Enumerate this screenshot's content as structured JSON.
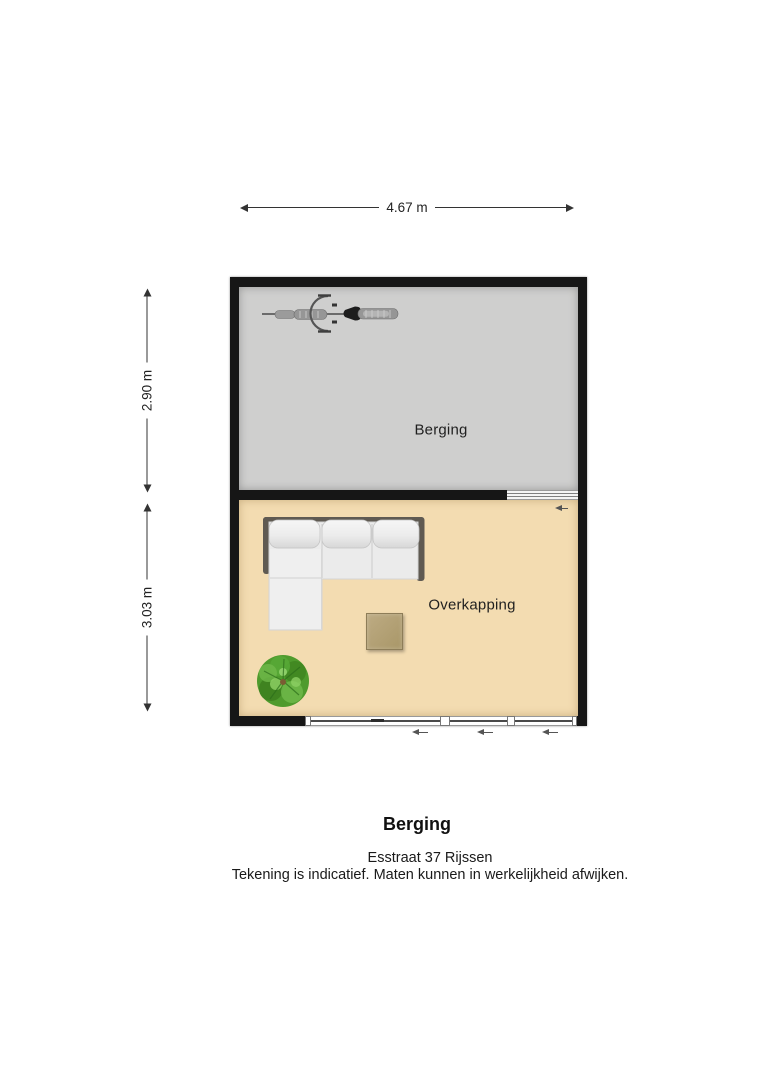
{
  "plan": {
    "wall_color": "#161616",
    "dimensions": [
      {
        "id": "total-width",
        "label": "4.67 m",
        "orientation": "horizontal"
      },
      {
        "id": "berging-depth",
        "label": "2.90 m",
        "orientation": "vertical"
      },
      {
        "id": "overkapping-depth",
        "label": "3.03 m",
        "orientation": "vertical"
      }
    ],
    "rooms": [
      {
        "id": "berging",
        "label": "Berging",
        "floor_color": "#cfcfce"
      },
      {
        "id": "overkapping",
        "label": "Overkapping",
        "floor_color": "#f3dcb1"
      }
    ],
    "furniture": [
      {
        "icon": "bicycle-icon",
        "room": "berging"
      },
      {
        "icon": "corner-sofa-icon",
        "room": "overkapping",
        "color": "#ebebeb"
      },
      {
        "icon": "side-table-icon",
        "room": "overkapping",
        "color": "#b3a179"
      },
      {
        "icon": "plant-icon",
        "room": "overkapping",
        "color": "#4f9b2d"
      }
    ]
  },
  "footer": {
    "title": "Berging",
    "address": "Esstraat 37 Rijssen",
    "disclaimer": "Tekening is indicatief. Maten kunnen in werkelijkheid afwijken."
  }
}
